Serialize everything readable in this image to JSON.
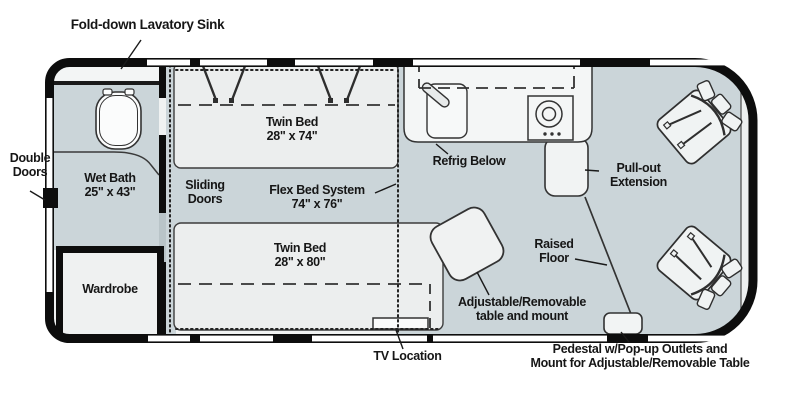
{
  "title": "Camper van floor plan",
  "colors": {
    "wall": "#0d0d0d",
    "floor": "#cbd5d9",
    "bed": "#eceeee",
    "counter": "#f4f6f6",
    "interior": "#f0f2f2",
    "text": "#161616",
    "window": "#ffffff"
  },
  "icons": {
    "toilet": "toilet-icon",
    "sink": "sink-faucet-icon",
    "stove": "stove-burner-icon",
    "chair": "swivel-chair-icon",
    "tv": "tv-icon"
  },
  "labels": {
    "fold_down_sink": "Fold-down Lavatory Sink",
    "double_doors": "Double\nDoors",
    "wet_bath": "Wet Bath\n25\" x 43\"",
    "wardrobe": "Wardrobe",
    "sliding_doors": "Sliding\nDoors",
    "twin_bed_top": "Twin Bed\n28\" x 74\"",
    "flex_bed": "Flex Bed System\n74\" x 76\"",
    "twin_bed_bottom": "Twin Bed\n28\" x 80\"",
    "refrig_below": "Refrig Below",
    "pull_out_extension": "Pull-out\nExtension",
    "raised_floor": "Raised\nFloor",
    "table_mount": "Adjustable/Removable\ntable and mount",
    "tv_location": "TV Location",
    "pedestal": "Pedestal w/Pop-up Outlets and\nMount for Adjustable/Removable Table"
  }
}
